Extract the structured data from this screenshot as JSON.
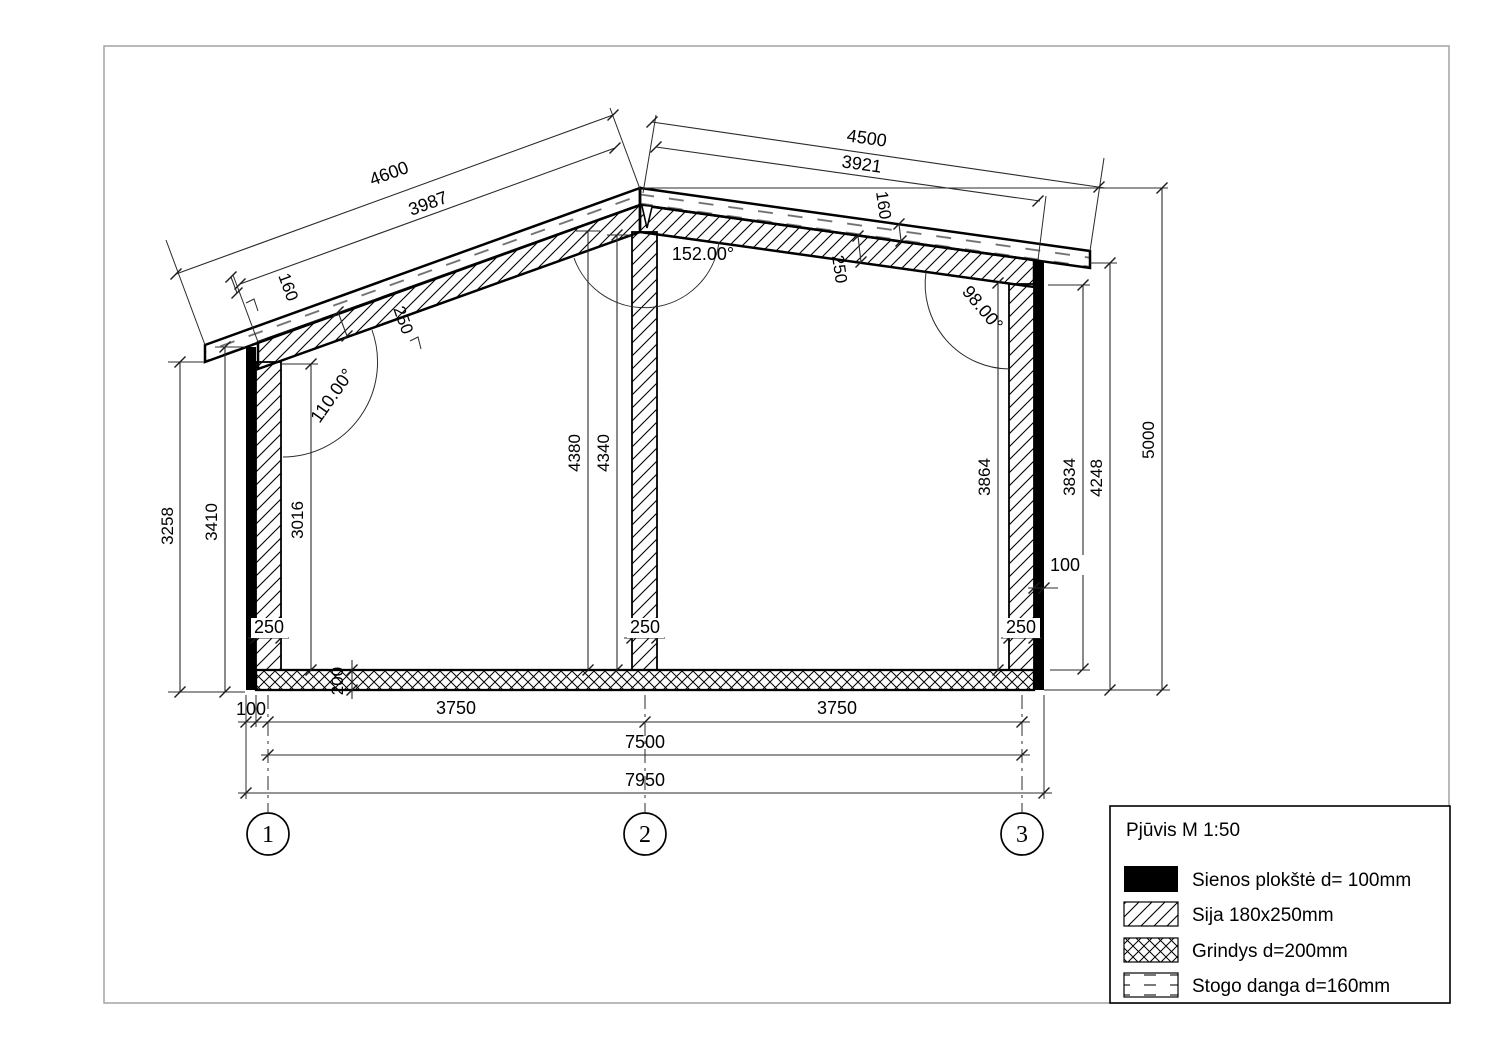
{
  "legend": {
    "title": "Pjūvis M 1:50",
    "items": [
      {
        "swatch": "solid-black",
        "label": "Sienos plokštė d= 100mm"
      },
      {
        "swatch": "diagonal-hatch",
        "label": "Sija 180x250mm"
      },
      {
        "swatch": "crosshatch",
        "label": "Grindys d=200mm"
      },
      {
        "swatch": "dashed",
        "label": "Stogo danga d=160mm"
      }
    ]
  },
  "grid_bubbles": {
    "b1": "1",
    "b2": "2",
    "b3": "3"
  },
  "dims": {
    "roof_left_overall": "4600",
    "roof_left_beam_len": "3987",
    "roof_right_overall": "4500",
    "roof_right_beam_len": "3921",
    "left_cover_thickness": "160",
    "left_beam_thickness": "250",
    "right_cover_thickness": "160",
    "right_beam_thickness": "250",
    "angle_left_wall": "110.00°",
    "angle_ridge": "152.00°",
    "angle_right_wall": "98.00°",
    "left_outer_height": "3258",
    "left_plate_height": "3410",
    "left_clear_height": "3016",
    "mid_col_height_a": "4380",
    "mid_col_height_b": "4340",
    "right_clear_height": "3864",
    "right_plate_height": "3834",
    "right_eave_height": "4248",
    "ridge_height": "5000",
    "left_col_width": "250",
    "mid_col_width": "250",
    "right_col_width": "250",
    "right_plate_width": "100",
    "floor_thickness": "200",
    "left_plate_width": "100",
    "span_1_2": "3750",
    "span_2_3": "3750",
    "span_1_3": "7500",
    "overall_width": "7950"
  }
}
